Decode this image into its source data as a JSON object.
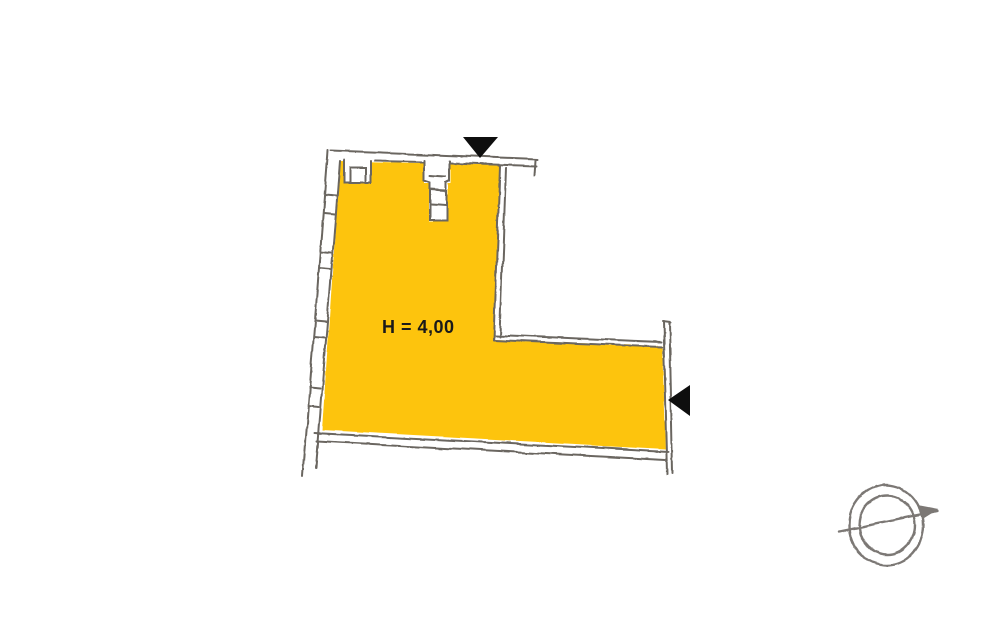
{
  "plan": {
    "room_label": "H = 4,00",
    "colors": {
      "background": "#ffffff",
      "room_fill": "#FDC40D",
      "wall": "#6b6661",
      "marker": "#0e0e0e",
      "compass": "#7b7874",
      "label_text": "#1a1a1a"
    }
  }
}
